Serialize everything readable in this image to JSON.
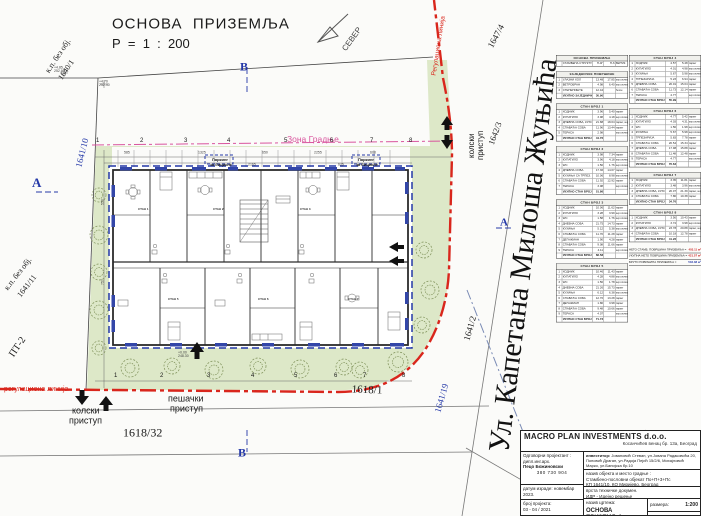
{
  "title": {
    "line1": "ОСНОВА  ПРИЗЕМЉА",
    "line2": "Р  =  1  :  200"
  },
  "north": {
    "label": "СЕВЕР"
  },
  "section_markers": {
    "top": "В",
    "bottom": "В",
    "left": "А",
    "right": "А"
  },
  "street_name": "Ул. Капетана Милоша Жуњића",
  "regulation_line": {
    "bottom": "регулациона линија",
    "right": "Регулациона линија"
  },
  "zone_label": "Зона Градње",
  "access": {
    "vehicle_1": "колски",
    "vehicle_2": "приступ",
    "pedestrian_1": "пешачки",
    "pedestrian_2": "приступ"
  },
  "parcels": {
    "p1640": [
      "к.п. без обј.",
      "1640/1"
    ],
    "p1641_11": [
      "к.п. без обј.",
      "1641/11"
    ],
    "p1641_10": "1641/10",
    "p1641_19": "1641/19",
    "p1641_2": "1641/2",
    "p1642_3": "1642/3",
    "p1647_4": "1647/4",
    "p1618_1": "1618/1",
    "p1618_32": "1618/32",
    "pt2": "ПТ-2"
  },
  "bike_parking": [
    "Паркинг",
    "за бицикле"
  ],
  "colors": {
    "regulation_red": "#d9261c",
    "zone_pink": "#d9559e",
    "marker_blue": "#2438a8",
    "grass_green": "#dde8c8",
    "tree_olive": "#7d8f57",
    "summary_red": "#cc2222"
  },
  "floating_labels": [
    {
      "t": "ОСНОВА  ПРИЗЕМЉА",
      "x": 112,
      "y": 16,
      "s": 15,
      "ls": 1
    },
    {
      "t": "Р  =  1  :  200",
      "x": 112,
      "y": 37,
      "s": 13
    },
    {
      "t": "СЕВЕР",
      "x": 341,
      "y": 48,
      "s": 8,
      "r": -54,
      "c": "#444"
    },
    {
      "t": "В",
      "x": 240,
      "y": 61,
      "s": 12,
      "c": "#2438a8",
      "f": "serif",
      "w": 700
    },
    {
      "t": "В",
      "x": 238,
      "y": 447,
      "s": 12,
      "c": "#2438a8",
      "f": "serif",
      "w": 700
    },
    {
      "t": "А",
      "x": 32,
      "y": 176,
      "s": 13,
      "c": "#2438a8",
      "f": "serif",
      "w": 700
    },
    {
      "t": "А",
      "x": 500,
      "y": 216,
      "s": 11,
      "c": "#2438a8",
      "f": "serif",
      "w": 700
    },
    {
      "t": "Ул. Капетана Милоша Жуњића",
      "x": 483,
      "y": 450,
      "s": 30,
      "r": -83,
      "f": "serif",
      "c": "#111"
    },
    {
      "t": "1647/4",
      "x": 486,
      "y": 45,
      "s": 9,
      "r": -62,
      "f": "serif"
    },
    {
      "t": "1642/3",
      "x": 487,
      "y": 143,
      "s": 8.5,
      "r": -70,
      "f": "serif"
    },
    {
      "t": "1641/2",
      "x": 462,
      "y": 339,
      "s": 9,
      "r": -74,
      "f": "serif"
    },
    {
      "t": "1641/19",
      "x": 433,
      "y": 411,
      "s": 9,
      "r": -74,
      "f": "serif",
      "c": "#2438a8"
    },
    {
      "t": "1641/10",
      "x": 74,
      "y": 166,
      "s": 9,
      "r": -76,
      "f": "serif",
      "c": "#2438a8"
    },
    {
      "t": "к.п. без обј.",
      "x": 44,
      "y": 70,
      "s": 8,
      "r": -56,
      "f": "serif"
    },
    {
      "t": "1640/1",
      "x": 57,
      "y": 77,
      "s": 8,
      "r": -56,
      "f": "serif"
    },
    {
      "t": "к.п. без обј.",
      "x": 3,
      "y": 287,
      "s": 8,
      "r": -52,
      "f": "serif"
    },
    {
      "t": "1641/11",
      "x": 16,
      "y": 294,
      "s": 8,
      "r": -52,
      "f": "serif"
    },
    {
      "t": "ПТ-2",
      "x": 7,
      "y": 353,
      "s": 10,
      "r": -56,
      "f": "serif"
    },
    {
      "t": "1618/32",
      "x": 123,
      "y": 427,
      "s": 12,
      "f": "serif"
    },
    {
      "t": "1618/1",
      "x": 352,
      "y": 383,
      "s": 11,
      "f": "serif",
      "r": 2
    },
    {
      "t": "регулациона линија",
      "x": 4,
      "y": 385,
      "s": 7,
      "c": "#d9261c"
    },
    {
      "t": "Регулациона линија",
      "x": 430,
      "y": 75,
      "s": 6.5,
      "r": -81,
      "c": "#d9261c"
    },
    {
      "t": "колски",
      "x": 72,
      "y": 406,
      "s": 9
    },
    {
      "t": "приступ",
      "x": 69,
      "y": 416,
      "s": 9
    },
    {
      "t": "пешачки",
      "x": 168,
      "y": 394,
      "s": 9
    },
    {
      "t": "приступ",
      "x": 170,
      "y": 404,
      "s": 9
    },
    {
      "t": "колски",
      "x": 468,
      "y": 158,
      "s": 8,
      "r": -90
    },
    {
      "t": "приступ",
      "x": 477,
      "y": 160,
      "s": 8,
      "r": -90
    },
    {
      "t": "Зона Градње",
      "x": 287,
      "y": 135,
      "s": 8.5,
      "c": "#d9559e"
    },
    {
      "t": "Паркинг",
      "x": 212,
      "y": 158,
      "s": 4,
      "w": 700
    },
    {
      "t": "за бицикле",
      "x": 210,
      "y": 163,
      "s": 4,
      "w": 700
    },
    {
      "t": "Паркинг",
      "x": 358,
      "y": 158,
      "s": 4,
      "w": 700
    },
    {
      "t": "за бицикле",
      "x": 356,
      "y": 163,
      "s": 4,
      "w": 700
    },
    {
      "t": "1",
      "x": 96,
      "y": 137,
      "s": 6
    },
    {
      "t": "2",
      "x": 140,
      "y": 137,
      "s": 6
    },
    {
      "t": "3",
      "x": 184,
      "y": 137,
      "s": 6
    },
    {
      "t": "4",
      "x": 227,
      "y": 137,
      "s": 6
    },
    {
      "t": "5",
      "x": 284,
      "y": 137,
      "s": 6
    },
    {
      "t": "6",
      "x": 330,
      "y": 137,
      "s": 6
    },
    {
      "t": "7",
      "x": 370,
      "y": 137,
      "s": 6
    },
    {
      "t": "8",
      "x": 409,
      "y": 137,
      "s": 6
    },
    {
      "t": "1",
      "x": 114,
      "y": 372,
      "s": 6
    },
    {
      "t": "2",
      "x": 160,
      "y": 372,
      "s": 6
    },
    {
      "t": "3",
      "x": 207,
      "y": 372,
      "s": 6
    },
    {
      "t": "4",
      "x": 251,
      "y": 372,
      "s": 6
    },
    {
      "t": "5",
      "x": 294,
      "y": 372,
      "s": 6
    },
    {
      "t": "6",
      "x": 334,
      "y": 372,
      "s": 6
    },
    {
      "t": "7",
      "x": 363,
      "y": 372,
      "s": 6
    },
    {
      "t": "8",
      "x": 402,
      "y": 372,
      "s": 6
    },
    {
      "t": "585",
      "x": 124,
      "y": 151,
      "s": 3.5,
      "c": "#444"
    },
    {
      "t": "1325",
      "x": 198,
      "y": 151,
      "s": 3.5,
      "c": "#444"
    },
    {
      "t": "650",
      "x": 262,
      "y": 151,
      "s": 3.5,
      "c": "#444"
    },
    {
      "t": "2255",
      "x": 314,
      "y": 151,
      "s": 3.5,
      "c": "#444"
    },
    {
      "t": "608",
      "x": 370,
      "y": 151,
      "s": 3.5,
      "c": "#444"
    },
    {
      "t": "550",
      "x": 101,
      "y": 205,
      "s": 3.5,
      "r": -90,
      "c": "#444"
    },
    {
      "t": "757",
      "x": 101,
      "y": 285,
      "s": 3.5,
      "r": -90,
      "c": "#444"
    },
    {
      "t": "2165",
      "x": 248,
      "y": 163,
      "s": 3.5,
      "c": "#444"
    },
    {
      "t": "625",
      "x": 338,
      "y": 163,
      "s": 3.5,
      "c": "#444"
    },
    {
      "t": "+4.85\n252.90",
      "x": 54,
      "y": 66,
      "s": 3.5,
      "c": "#444"
    },
    {
      "t": "+4.70\n252.40",
      "x": 99,
      "y": 80,
      "s": 3.5,
      "c": "#444"
    },
    {
      "t": "+0.00\n248.30",
      "x": 178,
      "y": 351,
      "s": 3.5,
      "c": "#444"
    },
    {
      "t": "СТАН 1",
      "x": 138,
      "y": 208,
      "s": 3,
      "w": 700,
      "c": "#333"
    },
    {
      "t": "СТАН 2",
      "x": 213,
      "y": 208,
      "s": 3,
      "w": 700,
      "c": "#333"
    },
    {
      "t": "СТАН 3",
      "x": 300,
      "y": 208,
      "s": 3,
      "w": 700,
      "c": "#333"
    },
    {
      "t": "СТАН 5",
      "x": 168,
      "y": 298,
      "s": 3,
      "w": 700,
      "c": "#333"
    },
    {
      "t": "СТАН 6",
      "x": 258,
      "y": 298,
      "s": 3,
      "w": 700,
      "c": "#333"
    },
    {
      "t": "СТАН 7",
      "x": 348,
      "y": 298,
      "s": 3,
      "w": 700,
      "c": "#333"
    }
  ],
  "tables_left": [
    {
      "title": "ОСНОВА ПРИЗЕМЉА",
      "rows": [
        [
          "",
          "СТАМБЕНА СТРУКТУРА",
          "П-4Г",
          "П-6",
          "ВЕРТИК."
        ]
      ]
    },
    {
      "title": "ЗАЈЕДНИЧКЕ ПОВРШИНЕ",
      "rows": [
        [
          "1",
          "УЛАЗНИ ХОЛ",
          "13.48",
          "17.85",
          "кер.плочице"
        ],
        [
          "2",
          "ВЕТРОБРАН",
          "4.98",
          "6.40",
          "кер.плочице"
        ],
        [
          "3",
          "СТЕПЕНИШТЕ",
          "12.44",
          "",
          "бетон"
        ]
      ],
      "total": [
        "УКУПНО ЗАЈЕДНИЧКЕ :",
        "30.90"
      ]
    },
    {
      "title": "СТАН БРОЈ 1",
      "rows": [
        [
          "1",
          "ХОДНИК",
          "3.96",
          "5.40",
          "паркет"
        ],
        [
          "2",
          "КУПАТИЛО",
          "3.98",
          "4.18",
          "кер.плочице"
        ],
        [
          "3",
          "ДНЕВНА СОБА, КУХИЊА",
          "21.88",
          "18.04",
          "паркет, кер.пл."
        ],
        [
          "4",
          "СПАВАЋА СОБА",
          "11.96",
          "13.44",
          "паркет"
        ],
        [
          "5",
          "ТЕРАСА",
          "2.98",
          "",
          "кер.плочице"
        ]
      ],
      "total": [
        "УКУПНО СТАН БРОЈ 1 :",
        "44.76"
      ]
    },
    {
      "title": "СТАН БРОЈ 2",
      "rows": [
        [
          "1",
          "ХОДНИК",
          "3.98",
          "7.34",
          "паркет"
        ],
        [
          "2",
          "КУПАТИЛО",
          "3.96",
          "4.18",
          "кер.плочице"
        ],
        [
          "3",
          "WC",
          "1.50",
          "1.76",
          "кер.плочице"
        ],
        [
          "4",
          "ДНЕВНА СОБА",
          "17.36",
          "14.07",
          "паркет"
        ],
        [
          "5",
          "КУХИЊА СА ТРПЕЗ.",
          "10.06",
          "8.98",
          "кер.плочице"
        ],
        [
          "6",
          "СПАВАЋА СОБА",
          "11.92",
          "12.92",
          "паркет"
        ],
        [
          "7",
          "ТЕРАСА",
          "3.08",
          "",
          "кер.плочице"
        ]
      ],
      "total": [
        "УКУПНО СТАН БРОЈ 2 :",
        "51.86"
      ]
    },
    {
      "title": "СТАН БРОЈ 3",
      "rows": [
        [
          "1",
          "ХОДНИК",
          "10.06",
          "11.62",
          "паркет"
        ],
        [
          "2",
          "КУПАТИЛО",
          "3.28",
          "3.99",
          "кер.плочице"
        ],
        [
          "3",
          "WC",
          "1.58",
          "1.76",
          "кер.плочице"
        ],
        [
          "4",
          "ДНЕВНА СОБА",
          "21.75",
          "14.73",
          "паркет"
        ],
        [
          "5",
          "КУХИЊА",
          "5.12",
          "5.38",
          "кер.плочице"
        ],
        [
          "6",
          "СПАВАЋА СОБА",
          "11.70",
          "11.28",
          "паркет"
        ],
        [
          "7",
          "ДЕГАЖМАН",
          "1.90",
          "4.28",
          "паркет"
        ],
        [
          "8",
          "СПАВАЋА СОБА",
          "9.08",
          "11.66",
          "паркет"
        ],
        [
          "9",
          "ТЕРАСА",
          "4.11",
          "",
          "кер.плочице"
        ]
      ],
      "total": [
        "УКУПНО СТАН БРОЈ 3 :",
        "68.58"
      ]
    },
    {
      "title": "СТАН БРОЈ 5",
      "rows": [
        [
          "1",
          "ХОДНИК",
          "10.46",
          "11.43",
          "паркет"
        ],
        [
          "2",
          "КУПАТИЛО",
          "4.28",
          "4.88",
          "кер.плочице"
        ],
        [
          "3",
          "WC",
          "1.56",
          "1.78",
          "кер.плочице"
        ],
        [
          "4",
          "ДНЕВНА СОБА",
          "21.26",
          "15.73",
          "паркет"
        ],
        [
          "5",
          "КУХИЊА",
          "6.12",
          "6.38",
          "кер.плочице"
        ],
        [
          "6",
          "СПАВАЋА СОБА",
          "12.70",
          "13.28",
          "паркет"
        ],
        [
          "7",
          "ДЕГАЖМАН",
          "1.80",
          "3.98",
          "паркет"
        ],
        [
          "8",
          "СПАВАЋА СОБА",
          "9.48",
          "10.66",
          "паркет"
        ],
        [
          "9",
          "ТЕРАСА",
          "4.07",
          "",
          "кер.плочице"
        ]
      ],
      "total": [
        "УКУПНО СТАН БРОЈ 5 :",
        "71.73"
      ]
    }
  ],
  "tables_right": [
    {
      "title": "СТАН БРОЈ 4",
      "rows": [
        [
          "1",
          "ХОДНИК",
          "4.57",
          "5.48",
          "паркет"
        ],
        [
          "2",
          "КУПАТИЛО",
          "4.01",
          "4.98",
          "кер.плочице"
        ],
        [
          "3",
          "КУХИЊА",
          "5.67",
          "5.98",
          "кер.плочице"
        ],
        [
          "4",
          "ТРПЕЗАРИЈА",
          "5.23",
          "6.94",
          "паркет"
        ],
        [
          "5",
          "ДНЕВНА СОБА",
          "20.01",
          "15.04",
          "паркет"
        ],
        [
          "6",
          "СПАВАЋА СОБА",
          "11.73",
          "12.14",
          "паркет"
        ],
        [
          "7",
          "ТЕРАСА",
          "4.77",
          "",
          "кер.плочице"
        ]
      ],
      "total": [
        "УКУПНО СТАН БРОЈ 4 :",
        "55.99"
      ]
    },
    {
      "title": "СТАН БРОЈ 6",
      "rows": [
        [
          "1",
          "ХОДНИК",
          "4.77",
          "5.42",
          "паркет"
        ],
        [
          "2",
          "КУПАТИЛО",
          "4.03",
          "4.31",
          "кер.плочице"
        ],
        [
          "3",
          "WC",
          "1.56",
          "1.98",
          "кер.плочице"
        ],
        [
          "4",
          "КУХИЊА",
          "5.67",
          "5.98",
          "кер.плочице"
        ],
        [
          "5",
          "ТРПЕЗАРИЈА",
          "5.83",
          "7.78",
          "паркет"
        ],
        [
          "6",
          "СПАВАЋА СОБА",
          "20.54",
          "15.34",
          "паркет"
        ],
        [
          "7",
          "ДНЕВНА СОБА",
          "17.98",
          "15.88",
          "паркет"
        ],
        [
          "8",
          "СПАВАЋА СОБА",
          "11.48",
          "12.48",
          "паркет"
        ],
        [
          "9",
          "ТЕРАСА",
          "4.77",
          "",
          "кер.плочице"
        ]
      ],
      "total": [
        "УКУПНО СТАН БРОЈ 6 :",
        "76.63"
      ]
    },
    {
      "title": "СТАН БРОЈ 7",
      "rows": [
        [
          "1",
          "ХОДНИК",
          "3.35",
          "11.81",
          "паркет"
        ],
        [
          "2",
          "КУПАТИЛО",
          "3.48",
          "3.96",
          "кер.плочице"
        ],
        [
          "3",
          "ДНЕВНА СОБА, КУХИЊА",
          "20.07",
          "21.39",
          "паркет, кер.пл."
        ],
        [
          "4",
          "СПАВАЋА СОБА",
          "7.86",
          "10.38",
          "паркет"
        ]
      ],
      "total": [
        "УКУПНО СТАН БРОЈ 7 :",
        "34.76"
      ]
    },
    {
      "title": "СТАН БРОЈ 8",
      "rows": [
        [
          "1",
          "ХОДНИК",
          "3.56",
          "10.43",
          "паркет"
        ],
        [
          "2",
          "КУПАТИЛО",
          "3.74",
          "3.98",
          "кер.плочице"
        ],
        [
          "3",
          "ДНЕВНА СОБА, КУХИЊА",
          "23.78",
          "20.88",
          "паркет, кер.пл."
        ],
        [
          "4",
          "СПАВАЋА СОБА",
          "10.18",
          "12.78",
          "паркет"
        ]
      ],
      "total": [
        "УКУПНО СТАН БРОЈ 8 :",
        "41.26"
      ]
    }
  ],
  "summary": [
    {
      "label": "НЕТО СТАМБ. ПОВРШИНА ПРИЗЕМЉА =",
      "value": "403.11 м²",
      "color": "#cc2222"
    },
    {
      "label": "УКУПНА НЕТО ПОВРШИНА ПРИЗЕМЉА =",
      "value": "421.57 м²",
      "color": "#cc2222"
    },
    {
      "label": "БРУТО ПОВРШИНА ПРИЗЕМЉА =",
      "value": "502.38 м²",
      "color": "#2438a8"
    }
  ],
  "titleblock": {
    "company": "MACRO PLAN INVESTMENTS d.o.o.",
    "company_address": "Косанчићев венац бр. 13а, Београд",
    "designer_label": "Одговорни пројектант :",
    "designer_title": "дипл.инг.арх.",
    "designer_name": "Пецо Божиновски",
    "designer_license": "380 730 904",
    "date_label": "датум израде:",
    "date_value": "новембар 2023.",
    "project_no_label": "број пројекта:",
    "project_no_value": "03 - 04 / 2021",
    "investor_label": "инвеститор:",
    "investor_value": "Јовановић Стеван, ул.Јована Радаковића 20, Поповић Драган, ул.Радоја Пејић 15/2/6, Михајловић Марко, ул.Банијска бр.10",
    "object_label": "назив објекта и место градње :",
    "object_value": "Стамбено-пословни објекат  По+П+3+Пс",
    "object_location": "КП 1641/10, КО Миријево, Београд",
    "doc_type_label": "врста техничке докумен.",
    "doc_type_value": "ИДР - Идејно решење",
    "drawing_label": "назив цртежа:",
    "drawing_value": "ОСНОВА ПРИЗЕМЉА",
    "scale_label": "размера:",
    "scale_value": "1:200",
    "sheet_label": "цртеж број:",
    "sheet_value": "06"
  }
}
